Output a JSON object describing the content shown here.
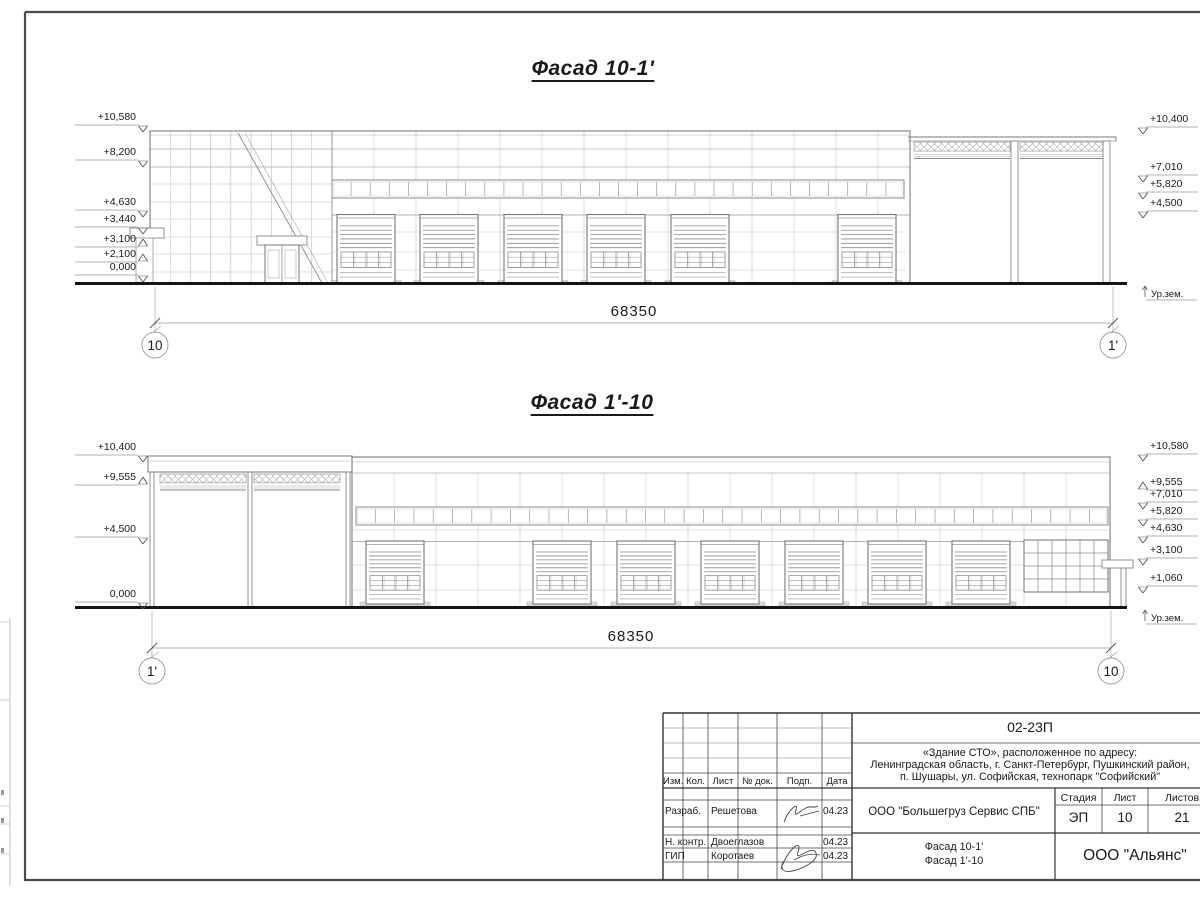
{
  "facade_top": {
    "title": "Фасад 10-1'",
    "dimension": "68350",
    "axis_left": "10",
    "axis_right": "1'",
    "ground_label": "Ур.зем.",
    "marks_left": [
      "+10,580",
      "+8,200",
      "+4,630",
      "+3,440",
      "+3,100",
      "+2,100",
      "0,000"
    ],
    "marks_right": [
      "+10,400",
      "+7,010",
      "+5,820",
      "+4,500"
    ]
  },
  "facade_bottom": {
    "title": "Фасад 1'-10",
    "dimension": "68350",
    "axis_left": "1'",
    "axis_right": "10",
    "ground_label": "Ур.зем.",
    "marks_left": [
      "+10,400",
      "+9,555",
      "+4,500",
      "0,000"
    ],
    "marks_right": [
      "+10,580",
      "+9,555",
      "+7,010",
      "+5,820",
      "+4,630",
      "+3,100",
      "+1,060"
    ]
  },
  "title_block": {
    "doc_number": "02-23П",
    "project_description": [
      "«Здание СТО», расположенное по адресу:",
      "Ленинградская область, г. Санкт-Петербург, Пушкинский район,",
      "п. Шушары, ул. Софийская, технопарк \"Софийский\""
    ],
    "columns": [
      "Изм.",
      "Кол.",
      "Лист",
      "№ док.",
      "Подп.",
      "Дата"
    ],
    "rows": [
      {
        "role": "Разраб.",
        "name": "Решетова",
        "date": "04.23"
      },
      {
        "role": "Н. контр.",
        "name": "Двоеглазов",
        "date": "04.23"
      },
      {
        "role": "ГИП",
        "name": "Коротаев",
        "date": "04.23"
      }
    ],
    "client": "ООО \"Большегруз Сервис СПБ\"",
    "stage_label": "Стадия",
    "stage": "ЭП",
    "sheet_label": "Лист",
    "sheet_number": "10",
    "sheets_label": "Листов",
    "sheets_total": "21",
    "drawing_titles": [
      "Фасад 10-1'",
      "Фасад 1'-10"
    ],
    "company": "ООО \"Альянс\""
  }
}
